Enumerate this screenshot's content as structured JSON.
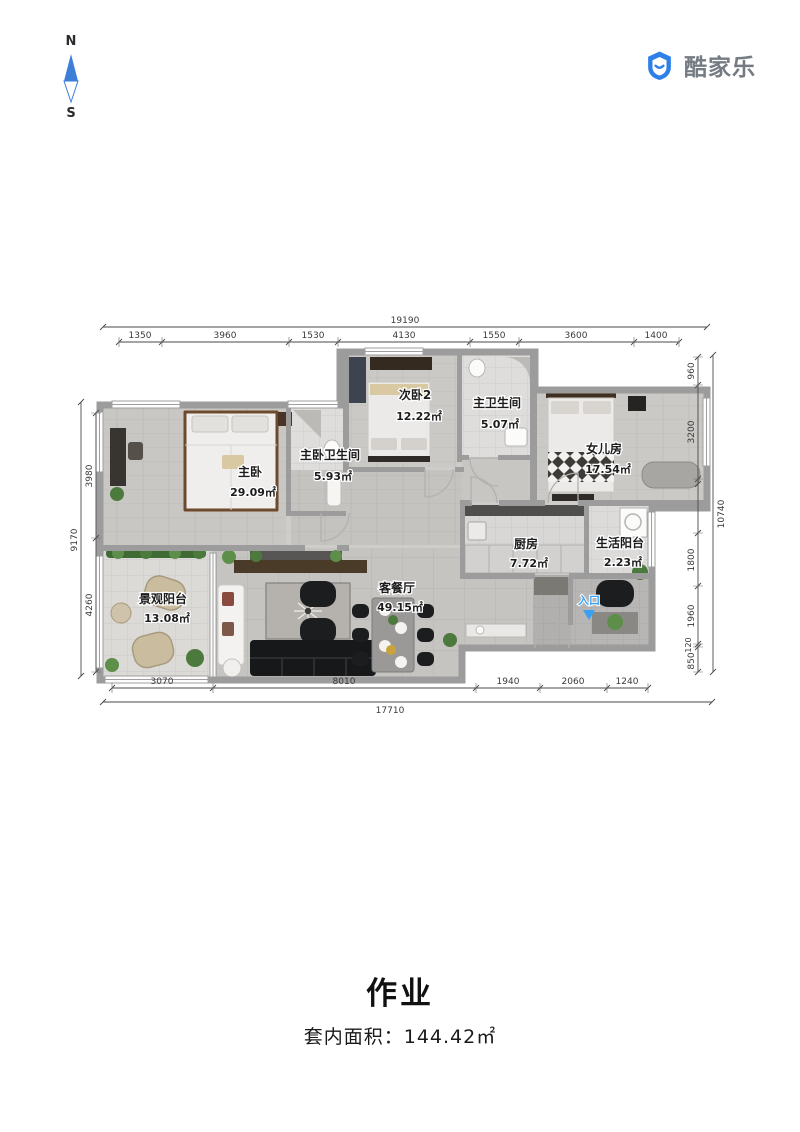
{
  "compass": {
    "north": "N",
    "south": "S"
  },
  "logo": {
    "brand": "酷家乐",
    "accent_color": "#2e7fe8",
    "text_color": "#757b83"
  },
  "plan": {
    "rooms": [
      {
        "name": "主卧",
        "area": "29.09㎡"
      },
      {
        "name": "主卧卫生间",
        "area": "5.93㎡"
      },
      {
        "name": "次卧2",
        "area": "12.22㎡"
      },
      {
        "name": "主卫生间",
        "area": "5.07㎡"
      },
      {
        "name": "女儿房",
        "area": "17.54㎡"
      },
      {
        "name": "厨房",
        "area": "7.72㎡"
      },
      {
        "name": "生活阳台",
        "area": "2.23㎡"
      },
      {
        "name": "景观阳台",
        "area": "13.08㎡"
      },
      {
        "name": "客餐厅",
        "area": "49.15㎡"
      }
    ],
    "entrance_label": "入口",
    "entrance_color": "#38a0f5",
    "wall_color": "#9c9c9c",
    "dimensions": {
      "top": {
        "total": "19190",
        "segments": [
          "1350",
          "3960",
          "1530",
          "4130",
          "1550",
          "3600",
          "1400"
        ]
      },
      "bottom": {
        "total": "17710",
        "segments": [
          "3070",
          "8010",
          "1940",
          "2060",
          "1240"
        ]
      },
      "left": {
        "total": "9170",
        "segments": [
          "3980",
          "4260"
        ]
      },
      "right": {
        "total": "10740",
        "segments": [
          "960",
          "3200",
          "1800",
          "1960",
          "120",
          "850"
        ]
      }
    }
  },
  "footer": {
    "title": "作业",
    "area_label": "套内面积：144.42㎡"
  }
}
